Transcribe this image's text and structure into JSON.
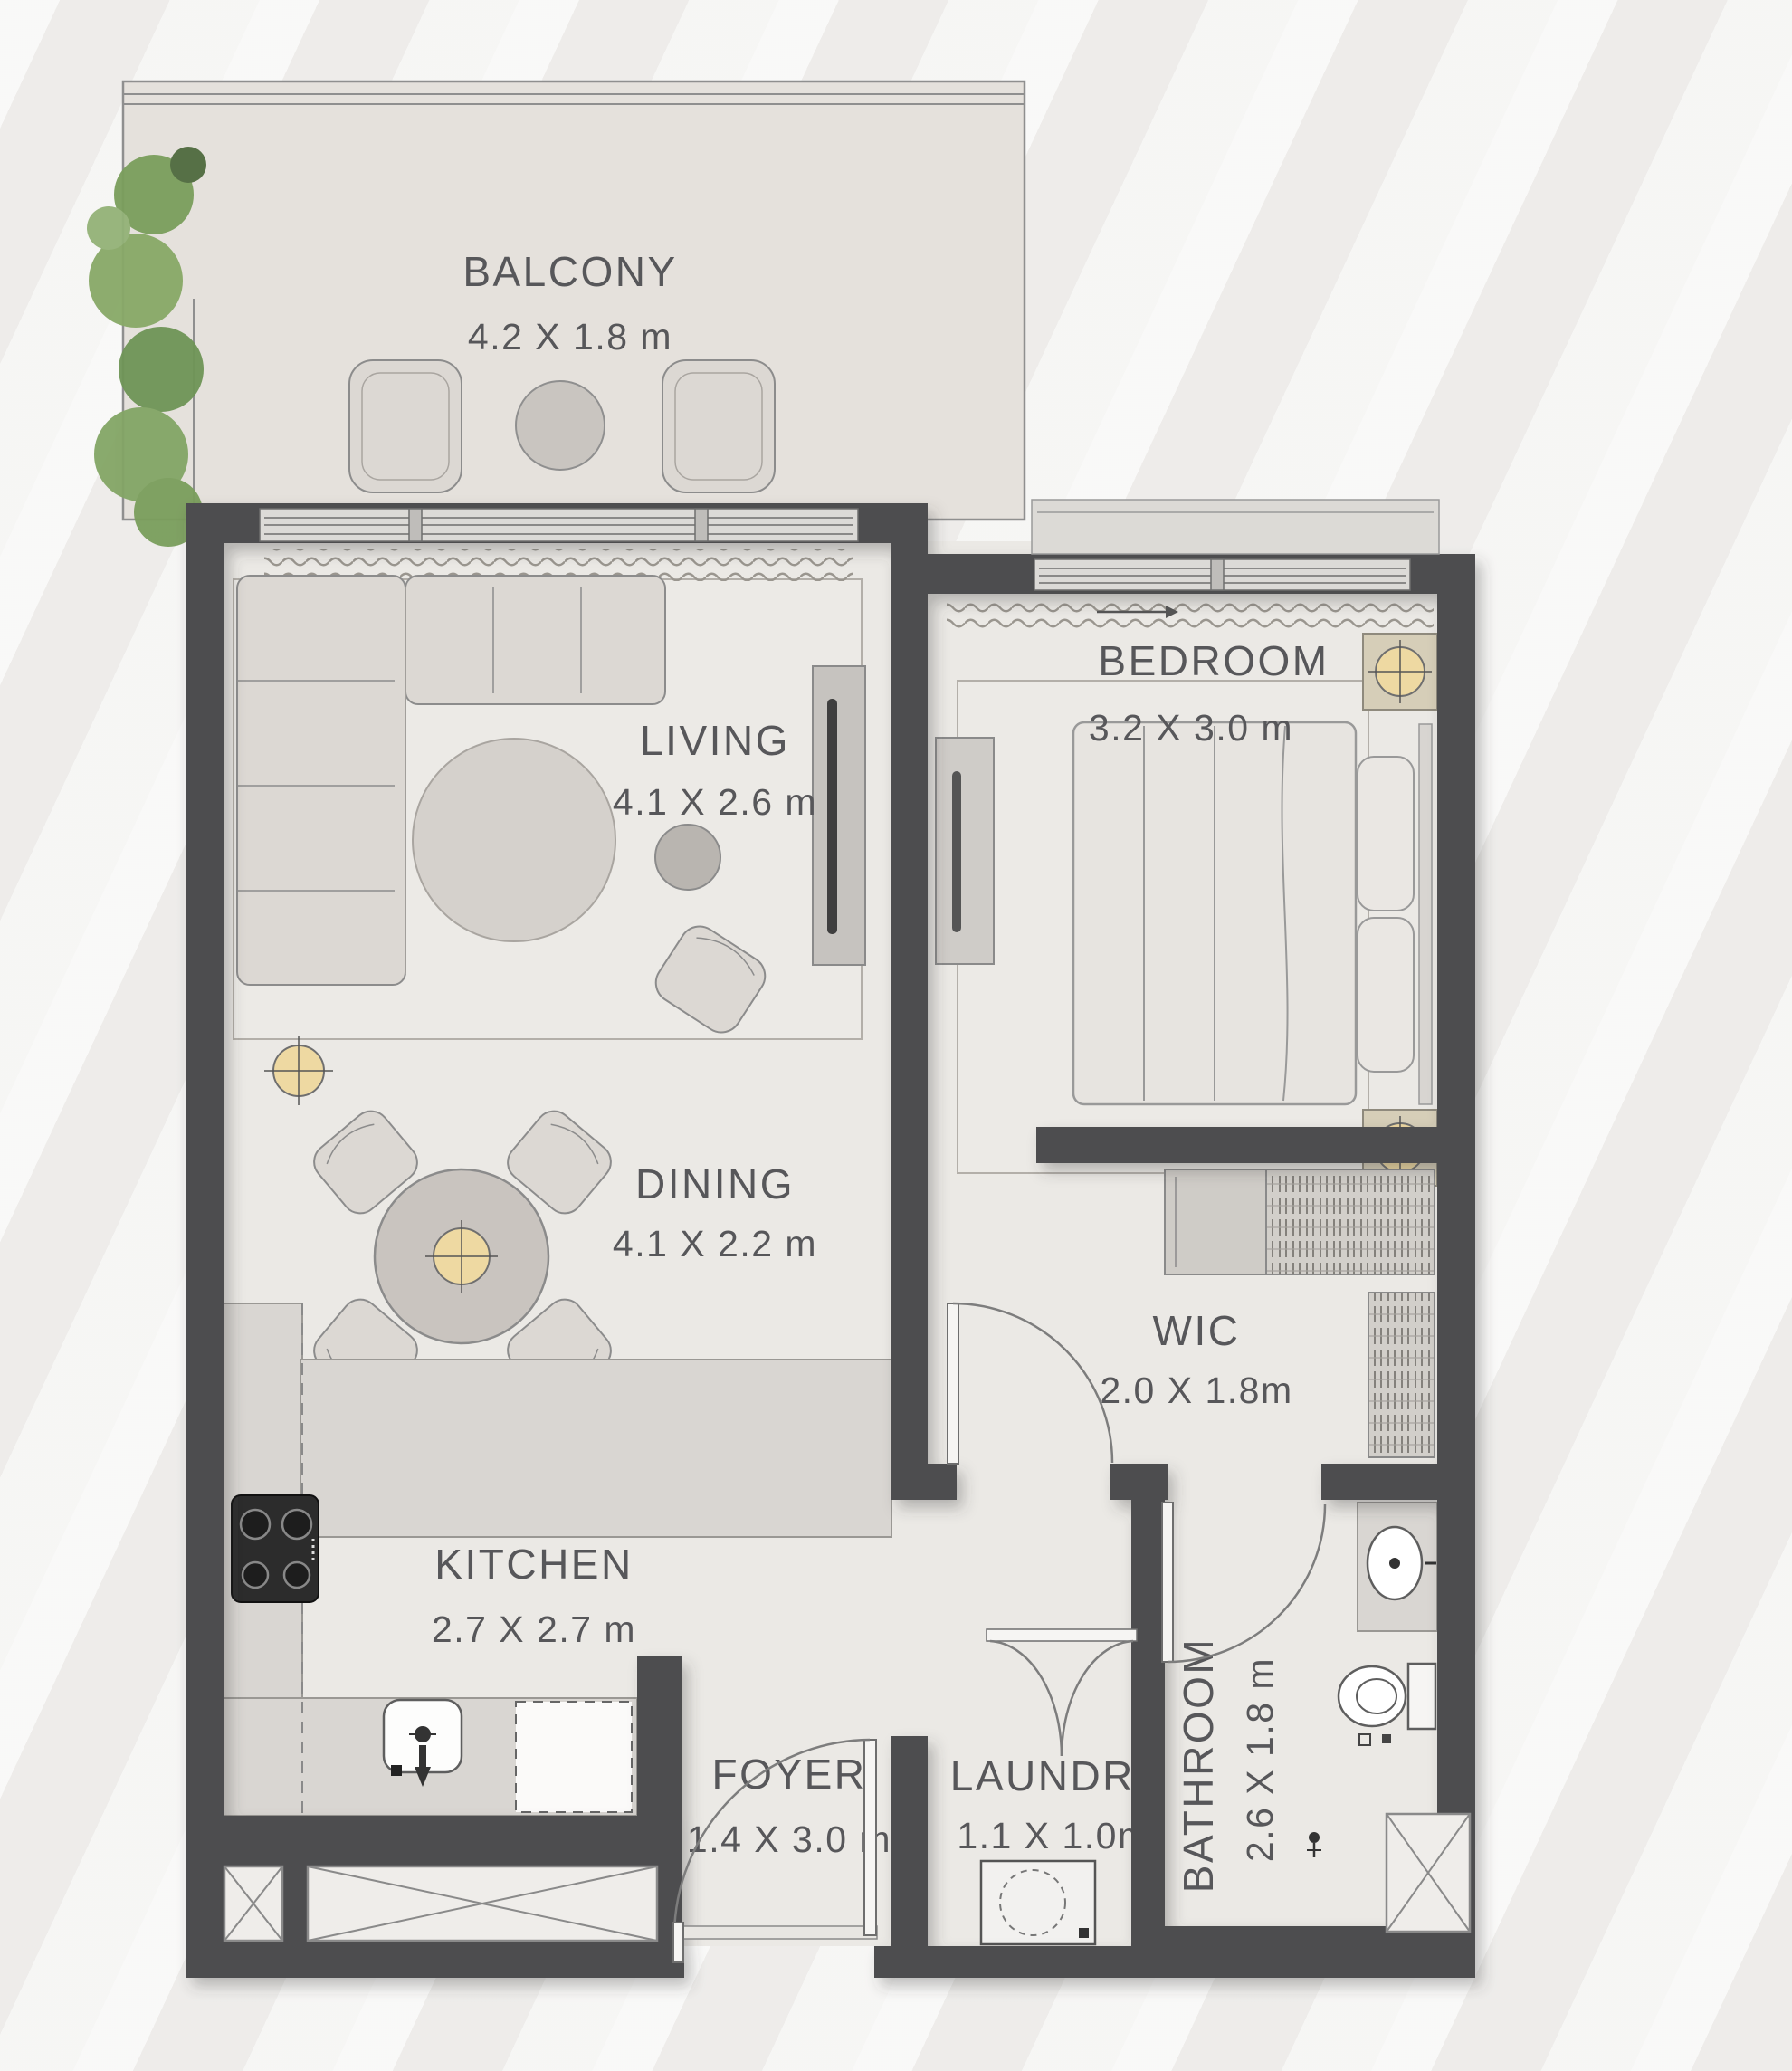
{
  "rooms": [
    {
      "id": "balcony",
      "name": "BALCONY",
      "dims": "4.2 X 1.8 m"
    },
    {
      "id": "living",
      "name": "LIVING",
      "dims": "4.1 X 2.6 m"
    },
    {
      "id": "bedroom",
      "name": "BEDROOM",
      "dims": "3.2 X 3.0 m"
    },
    {
      "id": "dining",
      "name": "DINING",
      "dims": "4.1 X 2.2 m"
    },
    {
      "id": "wic",
      "name": "WIC",
      "dims": "2.0 X 1.8m"
    },
    {
      "id": "kitchen",
      "name": "KITCHEN",
      "dims": "2.7 X 2.7 m"
    },
    {
      "id": "foyer",
      "name": "FOYER",
      "dims": "1.4 X 3.0 m"
    },
    {
      "id": "laundry",
      "name": "LAUNDRY",
      "dims": "1.1 X 1.0m"
    },
    {
      "id": "bathroom",
      "name": "BATHROOM",
      "dims": "2.6 X 1.8 m"
    }
  ],
  "colors": {
    "wall": "#4e4e50",
    "floor": "#ebe9e5",
    "counter": "#d9d6d2",
    "accent_lamp": "#eed9a2",
    "plant_green": "#7a9e5c",
    "label_text": "#57575a"
  }
}
